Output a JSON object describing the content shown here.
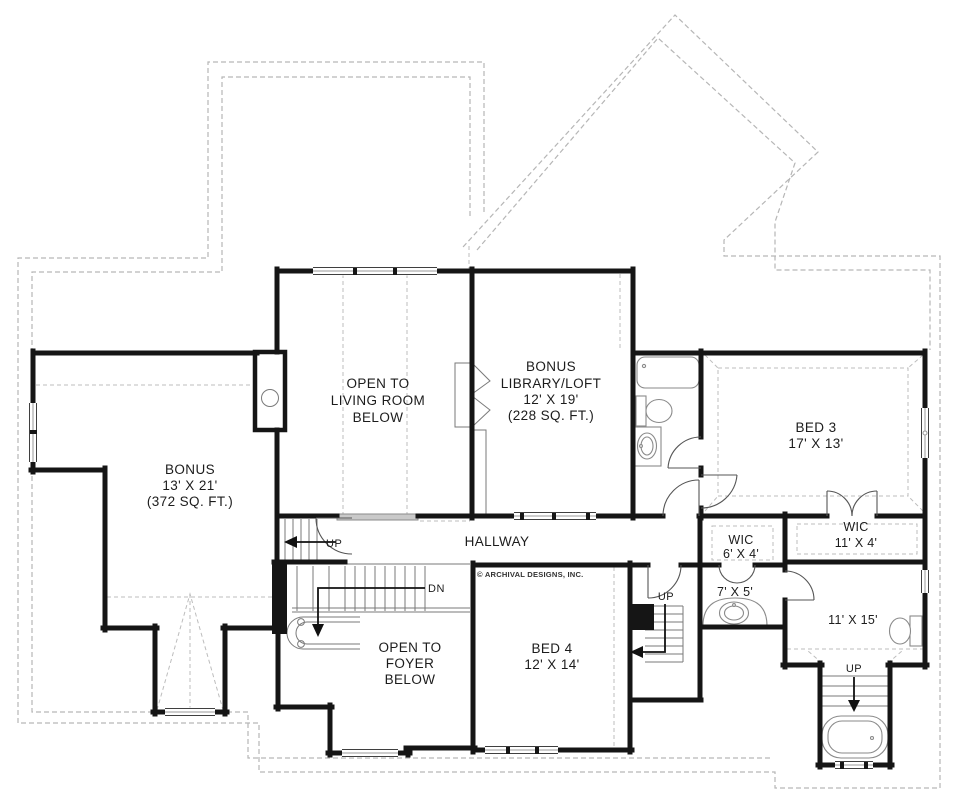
{
  "plan": {
    "copyright": "© ARCHIVAL DESIGNS, INC.",
    "rooms": {
      "open_living": {
        "l1": "OPEN TO",
        "l2": "LIVING ROOM",
        "l3": "BELOW"
      },
      "library": {
        "l1": "BONUS",
        "l2": "LIBRARY/LOFT",
        "l3": "12' X 19'",
        "l4": "(228 SQ. FT.)"
      },
      "bonus": {
        "l1": "BONUS",
        "l2": "13' X 21'",
        "l3": "(372 SQ. FT.)"
      },
      "bed3": {
        "l1": "BED 3",
        "l2": "17' X 13'"
      },
      "wic_large": {
        "l1": "WIC",
        "l2": "11' X 4'"
      },
      "wic_small": {
        "l1": "WIC",
        "l2": "6' X 4'"
      },
      "hallway": {
        "l1": "HALLWAY"
      },
      "bath_small": {
        "l1": "7' X 5'"
      },
      "room_11x15": {
        "l1": "11' X 15'"
      },
      "bed4": {
        "l1": "BED 4",
        "l2": "12' X 14'"
      },
      "open_foyer": {
        "l1": "OPEN TO",
        "l2": "FOYER",
        "l3": "BELOW"
      }
    },
    "annotations": {
      "up": "UP",
      "dn": "DN"
    }
  }
}
